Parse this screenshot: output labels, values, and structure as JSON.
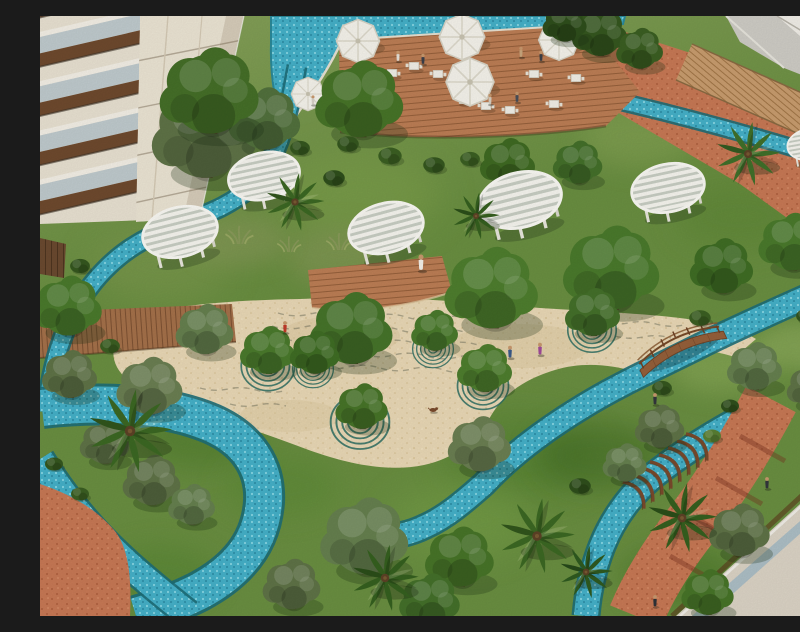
{
  "scene": {
    "description": "Aerial architectural rendering of a resort courtyard garden: winding turquoise mosaic streams, sandy plaza with concentric ring motifs around trees, white circular slatted pergolas, rooftop pool deck with white umbrellas, wooden arched bridge, palms and olive trees between residential buildings",
    "palette": {
      "grass": "#6a8f41",
      "grassDark": "#4c7229",
      "grassLight": "#85a855",
      "sand": "#ead9b6",
      "sandShadow": "#d8c193",
      "water": "#45b1c9",
      "waterDeep": "#1d6e78",
      "waterLight": "#8fdce8",
      "deckWood": "#bd7e55",
      "walkWood": "#c99d6f",
      "plankWood": "#a5714a",
      "terracotta": "#c87955",
      "terracottaDark": "#b0603e",
      "buildingCream": "#e9e2d2",
      "pergolaWhite": "#f7f6f0",
      "canopyGreen": "#4a7a2c",
      "canopyOlive": "#5f7347",
      "palmGreen": "#3c6823",
      "bridgeWood": "#8a5a33",
      "roofBeige": "#dcd4c6",
      "roofGlass": "#adbfc6",
      "ringTeal": "#2e6f63",
      "umbrellaWhite": "#f6f4ec"
    },
    "legend": "elements: t=symbol type, x/y=position px, s=scale, r=rotation deg, f=fill, layer=paint layer",
    "elements": [
      {
        "t": "patch",
        "n": "grass-patch",
        "layer": "ground",
        "x": 120,
        "y": 250,
        "s": 2.2,
        "f": "#7e9a4f"
      },
      {
        "t": "patch",
        "n": "grass-patch",
        "layer": "ground",
        "x": 320,
        "y": 180,
        "s": 2.5,
        "f": "#7fa14c"
      },
      {
        "t": "patch",
        "n": "grass-patch",
        "layer": "ground",
        "x": 600,
        "y": 120,
        "s": 1.8,
        "f": "#87a455"
      },
      {
        "t": "patch",
        "n": "grass-patch",
        "layer": "ground",
        "x": 700,
        "y": 200,
        "s": 2.0,
        "f": "#5d8636"
      },
      {
        "t": "patch",
        "n": "grass-patch",
        "layer": "ground",
        "x": 160,
        "y": 420,
        "s": 2.0,
        "f": "#4e7a2c"
      },
      {
        "t": "patch",
        "n": "grass-patch",
        "layer": "ground",
        "x": 480,
        "y": 440,
        "s": 2.4,
        "f": "#51802e"
      },
      {
        "t": "patch",
        "n": "grass-patch",
        "layer": "ground",
        "x": 680,
        "y": 350,
        "s": 1.6,
        "f": "#8fae5b"
      },
      {
        "t": "patch",
        "n": "grass-patch",
        "layer": "ground",
        "x": 240,
        "y": 470,
        "s": 1.8,
        "f": "#5c8a36"
      },
      {
        "t": "patch",
        "n": "grass-patch",
        "layer": "ground",
        "x": 420,
        "y": 505,
        "s": 2.2,
        "f": "#76a046"
      },
      {
        "t": "patch",
        "n": "grass-patch",
        "layer": "ground",
        "x": 120,
        "y": 560,
        "s": 1.8,
        "f": "#558532"
      },
      {
        "t": "patch",
        "n": "grass-patch",
        "layer": "ground",
        "x": 760,
        "y": 330,
        "s": 1.4,
        "f": "#97b363"
      },
      {
        "t": "patch",
        "n": "grass-patch",
        "layer": "ground",
        "x": 300,
        "y": 240,
        "s": 1.7,
        "f": "#8a9a5b"
      },
      {
        "t": "patch",
        "n": "grass-patch",
        "layer": "ground",
        "x": 200,
        "y": 225,
        "s": 1.5,
        "f": "#8a9a5b"
      },
      {
        "t": "patch",
        "n": "grass-patch",
        "layer": "ground",
        "x": 560,
        "y": 440,
        "s": 2.0,
        "f": "#3f6a22"
      },
      {
        "t": "patch",
        "n": "grass-patch",
        "layer": "ground",
        "x": 640,
        "y": 560,
        "s": 1.8,
        "f": "#477428"
      },
      {
        "t": "tuft",
        "n": "tall-grass",
        "x": 160,
        "y": 214,
        "s": 1.2
      },
      {
        "t": "tuft",
        "n": "tall-grass",
        "x": 198,
        "y": 228,
        "s": 1.4
      },
      {
        "t": "tuft",
        "n": "tall-grass",
        "x": 248,
        "y": 236,
        "s": 1.2
      },
      {
        "t": "tuft",
        "n": "tall-grass",
        "x": 298,
        "y": 234,
        "s": 1.3
      },
      {
        "t": "tuft",
        "n": "tall-grass",
        "x": 146,
        "y": 238,
        "s": 1.1
      },
      {
        "t": "tuft",
        "n": "tall-grass",
        "x": 338,
        "y": 226,
        "s": 1.2
      },
      {
        "t": "ring",
        "n": "ring-motif",
        "x": 228,
        "y": 350,
        "s": 1.05
      },
      {
        "t": "ring",
        "n": "ring-motif",
        "x": 320,
        "y": 406,
        "s": 1.15
      },
      {
        "t": "ring",
        "n": "ring-motif",
        "x": 443,
        "y": 370,
        "s": 1.0
      },
      {
        "t": "ring",
        "n": "ring-motif",
        "x": 552,
        "y": 314,
        "s": 0.95
      },
      {
        "t": "ring",
        "n": "ring-motif",
        "x": 393,
        "y": 333,
        "s": 0.8
      },
      {
        "t": "ring",
        "n": "ring-motif",
        "x": 273,
        "y": 353,
        "s": 0.8
      },
      {
        "t": "rib",
        "n": "stream-pergola-rib",
        "x": 658,
        "y": 430,
        "r": 52
      },
      {
        "t": "rib",
        "n": "stream-pergola-rib",
        "x": 649,
        "y": 437,
        "r": 52
      },
      {
        "t": "rib",
        "n": "stream-pergola-rib",
        "x": 640,
        "y": 444,
        "r": 52
      },
      {
        "t": "rib",
        "n": "stream-pergola-rib",
        "x": 631,
        "y": 451,
        "r": 52
      },
      {
        "t": "rib",
        "n": "stream-pergola-rib",
        "x": 622,
        "y": 458,
        "r": 52
      },
      {
        "t": "rib",
        "n": "stream-pergola-rib",
        "x": 613,
        "y": 464,
        "r": 52
      },
      {
        "t": "rib",
        "n": "stream-pergola-rib",
        "x": 604,
        "y": 471,
        "r": 52
      },
      {
        "t": "rib",
        "n": "stream-pergola-rib",
        "x": 595,
        "y": 478,
        "r": 52
      },
      {
        "t": "table",
        "n": "deck-table",
        "x": 352,
        "y": 57,
        "s": 1.2
      },
      {
        "t": "table",
        "n": "deck-table",
        "x": 374,
        "y": 50,
        "s": 1.2
      },
      {
        "t": "table",
        "n": "deck-table",
        "x": 398,
        "y": 58,
        "s": 1.2
      },
      {
        "t": "table",
        "n": "deck-table",
        "x": 424,
        "y": 84,
        "s": 1.2
      },
      {
        "t": "table",
        "n": "deck-table",
        "x": 446,
        "y": 90,
        "s": 1.2
      },
      {
        "t": "table",
        "n": "deck-table",
        "x": 470,
        "y": 94,
        "s": 1.2
      },
      {
        "t": "table",
        "n": "deck-table",
        "x": 494,
        "y": 58,
        "s": 1.2
      },
      {
        "t": "table",
        "n": "deck-table",
        "x": 514,
        "y": 88,
        "s": 1.2
      },
      {
        "t": "table",
        "n": "deck-table",
        "x": 536,
        "y": 62,
        "s": 1.2
      },
      {
        "t": "umbrella",
        "n": "pool-umbrella",
        "x": 318,
        "y": 25,
        "s": 1.8
      },
      {
        "t": "umbrella",
        "n": "pool-umbrella",
        "x": 422,
        "y": 21,
        "s": 1.9
      },
      {
        "t": "umbrella",
        "n": "pool-umbrella",
        "x": 430,
        "y": 66,
        "s": 2.0
      },
      {
        "t": "umbrella",
        "n": "pool-umbrella",
        "x": 519,
        "y": 24,
        "s": 1.7
      },
      {
        "t": "umbrella",
        "n": "pool-umbrella",
        "x": 268,
        "y": 78,
        "s": 1.4
      },
      {
        "t": "tree",
        "n": "tree",
        "x": 560,
        "y": 18,
        "s": 1.0,
        "f": "#35571f"
      },
      {
        "t": "tree",
        "n": "tree",
        "x": 600,
        "y": 34,
        "s": 0.85,
        "f": "#3b5f22"
      },
      {
        "t": "tree",
        "n": "tree",
        "x": 525,
        "y": 8,
        "s": 0.8,
        "f": "#2f4f1c"
      },
      {
        "t": "tree",
        "n": "olive-tree",
        "x": 165,
        "y": 120,
        "s": 1.9,
        "f": "#5f7347"
      },
      {
        "t": "tree",
        "n": "olive-tree",
        "x": 225,
        "y": 105,
        "s": 1.3,
        "f": "#52713d"
      },
      {
        "t": "tree",
        "n": "tree",
        "x": 170,
        "y": 78,
        "s": 1.8,
        "f": "#456f28"
      },
      {
        "t": "tree",
        "n": "tree",
        "x": 320,
        "y": 86,
        "s": 1.6,
        "f": "#477428"
      },
      {
        "t": "tree",
        "n": "tree",
        "x": 468,
        "y": 148,
        "s": 1.0,
        "f": "#3f6a22"
      },
      {
        "t": "tree",
        "n": "tree",
        "x": 538,
        "y": 148,
        "s": 0.9,
        "f": "#44702a"
      },
      {
        "t": "pergola",
        "n": "round-pergola",
        "x": 140,
        "y": 216,
        "s": 0.95,
        "r": -14
      },
      {
        "t": "pergola",
        "n": "round-pergola",
        "x": 224,
        "y": 160,
        "s": 0.9,
        "r": -12
      },
      {
        "t": "pergola",
        "n": "round-pergola",
        "x": 346,
        "y": 212,
        "s": 0.95,
        "r": -15
      },
      {
        "t": "pergola",
        "n": "round-pergola",
        "x": 480,
        "y": 184,
        "s": 1.05,
        "r": -14
      },
      {
        "t": "pergola",
        "n": "round-pergola",
        "x": 628,
        "y": 172,
        "s": 0.92,
        "r": -12
      },
      {
        "t": "pergola",
        "n": "round-pergola",
        "x": 772,
        "y": 128,
        "s": 0.62,
        "r": -10
      },
      {
        "t": "tree",
        "n": "tree",
        "x": 572,
        "y": 255,
        "s": 1.75,
        "f": "#4a7a2c"
      },
      {
        "t": "tree",
        "n": "tree",
        "x": 682,
        "y": 252,
        "s": 1.15,
        "f": "#3f6d24"
      },
      {
        "t": "tree",
        "n": "tree",
        "x": 752,
        "y": 228,
        "s": 1.2,
        "f": "#4a7a2c"
      },
      {
        "t": "tree",
        "n": "tree",
        "x": 452,
        "y": 275,
        "s": 1.7,
        "f": "#4e7e2e"
      },
      {
        "t": "tree",
        "n": "tree",
        "x": 312,
        "y": 315,
        "s": 1.5,
        "f": "#46742a"
      },
      {
        "t": "tree",
        "n": "tree",
        "x": 28,
        "y": 292,
        "s": 1.25,
        "f": "#4a7a2c"
      },
      {
        "t": "tree",
        "n": "olive-tree",
        "x": 110,
        "y": 372,
        "s": 1.2,
        "f": "#6b7f52"
      },
      {
        "t": "tree",
        "n": "olive-tree",
        "x": 30,
        "y": 360,
        "s": 1.0,
        "f": "#5f7347"
      },
      {
        "t": "tree",
        "n": "olive-tree",
        "x": 165,
        "y": 315,
        "s": 1.05,
        "f": "#66804f"
      },
      {
        "t": "tree",
        "n": "plaza-tree",
        "x": 228,
        "y": 336,
        "s": 1.0,
        "f": "#4a7a2c"
      },
      {
        "t": "tree",
        "n": "plaza-tree",
        "x": 322,
        "y": 392,
        "s": 0.95,
        "f": "#477428"
      },
      {
        "t": "tree",
        "n": "plaza-tree",
        "x": 445,
        "y": 354,
        "s": 1.0,
        "f": "#4e7e2e"
      },
      {
        "t": "tree",
        "n": "plaza-tree",
        "x": 553,
        "y": 298,
        "s": 1.0,
        "f": "#44702a"
      },
      {
        "t": "tree",
        "n": "plaza-tree",
        "x": 395,
        "y": 316,
        "s": 0.85,
        "f": "#4a7a2c"
      },
      {
        "t": "tree",
        "n": "plaza-tree",
        "x": 275,
        "y": 338,
        "s": 0.9,
        "f": "#3f6d24"
      },
      {
        "t": "tree",
        "n": "olive-tree",
        "x": 440,
        "y": 430,
        "s": 1.15,
        "f": "#6b7f52"
      },
      {
        "t": "tree",
        "n": "olive-tree",
        "x": 325,
        "y": 523,
        "s": 1.6,
        "f": "#66804f"
      },
      {
        "t": "tree",
        "n": "olive-tree",
        "x": 112,
        "y": 466,
        "s": 1.05,
        "f": "#5f7347"
      },
      {
        "t": "tree",
        "n": "olive-tree",
        "x": 152,
        "y": 490,
        "s": 0.85,
        "f": "#66804f"
      },
      {
        "t": "tree",
        "n": "olive-tree",
        "x": 65,
        "y": 428,
        "s": 0.9,
        "f": "#5f7347"
      },
      {
        "t": "tree",
        "n": "tree",
        "x": 420,
        "y": 543,
        "s": 1.25,
        "f": "#477428"
      },
      {
        "t": "tree",
        "n": "olive-tree",
        "x": 252,
        "y": 570,
        "s": 1.05,
        "f": "#5f7347"
      },
      {
        "t": "tree",
        "n": "tree",
        "x": 390,
        "y": 586,
        "s": 1.1,
        "f": "#44702a"
      },
      {
        "t": "tree",
        "n": "olive-tree",
        "x": 620,
        "y": 412,
        "s": 0.9,
        "f": "#5f7347"
      },
      {
        "t": "tree",
        "n": "olive-tree",
        "x": 585,
        "y": 448,
        "s": 0.8,
        "f": "#66804f"
      },
      {
        "t": "tree",
        "n": "olive-tree",
        "x": 715,
        "y": 352,
        "s": 1.0,
        "f": "#66804f"
      },
      {
        "t": "tree",
        "n": "olive-tree",
        "x": 772,
        "y": 372,
        "s": 0.9,
        "f": "#5f7347"
      },
      {
        "t": "tree",
        "n": "olive-tree",
        "x": 700,
        "y": 516,
        "s": 1.1,
        "f": "#5f7347"
      },
      {
        "t": "tree",
        "n": "tree",
        "x": 668,
        "y": 578,
        "s": 0.95,
        "f": "#477428"
      },
      {
        "t": "palm",
        "n": "palm-tree",
        "x": 90,
        "y": 415,
        "s": 1.5,
        "f": "#3c6823"
      },
      {
        "t": "palm",
        "n": "palm-tree",
        "x": 345,
        "y": 562,
        "s": 1.2,
        "f": "#35601f"
      },
      {
        "t": "palm",
        "n": "palm-tree",
        "x": 497,
        "y": 520,
        "s": 1.35,
        "f": "#3c6823"
      },
      {
        "t": "palm",
        "n": "palm-tree",
        "x": 642,
        "y": 502,
        "s": 1.25,
        "f": "#35601f"
      },
      {
        "t": "palm",
        "n": "palm-tree",
        "x": 255,
        "y": 186,
        "s": 1.05,
        "f": "#3c6823"
      },
      {
        "t": "palm",
        "n": "palm-tree",
        "x": 708,
        "y": 138,
        "s": 1.15,
        "f": "#40702a"
      },
      {
        "t": "palm",
        "n": "palm-tree",
        "x": 786,
        "y": 270,
        "s": 1.0,
        "f": "#3c6823"
      },
      {
        "t": "palm",
        "n": "palm-tree",
        "x": 436,
        "y": 200,
        "s": 0.85,
        "f": "#35601f"
      },
      {
        "t": "palm",
        "n": "palm-tree",
        "x": 546,
        "y": 556,
        "s": 0.95,
        "f": "#2f5a20"
      },
      {
        "t": "bush",
        "n": "bush",
        "x": 308,
        "y": 128,
        "s": 1.2,
        "f": "#35571f"
      },
      {
        "t": "bush",
        "n": "bush",
        "x": 350,
        "y": 140,
        "s": 1.3,
        "f": "#3b5f22"
      },
      {
        "t": "bush",
        "n": "bush",
        "x": 394,
        "y": 149,
        "s": 1.2,
        "f": "#35571f"
      },
      {
        "t": "bush",
        "n": "bush",
        "x": 430,
        "y": 143,
        "s": 1.1,
        "f": "#3b5f22"
      },
      {
        "t": "bush",
        "n": "bush",
        "x": 294,
        "y": 162,
        "s": 1.2,
        "f": "#2f4f1c"
      },
      {
        "t": "bush",
        "n": "bush",
        "x": 260,
        "y": 132,
        "s": 1.1,
        "f": "#35571f"
      },
      {
        "t": "bush",
        "n": "bush",
        "x": 660,
        "y": 302,
        "s": 1.2,
        "f": "#3b5f22"
      },
      {
        "t": "bush",
        "n": "bush",
        "x": 622,
        "y": 372,
        "s": 1.1,
        "f": "#35571f"
      },
      {
        "t": "bush",
        "n": "bush",
        "x": 540,
        "y": 470,
        "s": 1.2,
        "f": "#2f4f1c"
      },
      {
        "t": "bush",
        "n": "bush",
        "x": 766,
        "y": 300,
        "s": 1.1,
        "f": "#35571f"
      },
      {
        "t": "bush",
        "n": "bush",
        "x": 70,
        "y": 330,
        "s": 1.1,
        "f": "#3b5f22"
      },
      {
        "t": "bush",
        "n": "bush",
        "x": 40,
        "y": 250,
        "s": 1.1,
        "f": "#35571f"
      },
      {
        "t": "bush",
        "n": "bush",
        "x": 690,
        "y": 390,
        "s": 1.0,
        "f": "#2f4f1c"
      },
      {
        "t": "bush",
        "n": "bush",
        "x": 770,
        "y": 252,
        "s": 1.0,
        "f": "#35571f"
      },
      {
        "t": "bush",
        "n": "bush",
        "x": 14,
        "y": 448,
        "s": 1.0,
        "f": "#35571f"
      },
      {
        "t": "bush",
        "n": "bush",
        "x": 40,
        "y": 478,
        "s": 1.0,
        "f": "#3b5f22"
      },
      {
        "t": "bush",
        "n": "bush",
        "x": 672,
        "y": 420,
        "s": 1.0,
        "f": "#597f33"
      },
      {
        "t": "person",
        "n": "deck-person",
        "x": 358,
        "y": 41,
        "s": 1.0,
        "f": "#e8e3da"
      },
      {
        "t": "person",
        "n": "deck-person",
        "x": 383,
        "y": 44,
        "s": 1.0,
        "f": "#3a3f4a"
      },
      {
        "t": "person",
        "n": "deck-person",
        "x": 450,
        "y": 84,
        "s": 1.0,
        "f": "#d8cfc0"
      },
      {
        "t": "person",
        "n": "deck-person",
        "x": 477,
        "y": 82,
        "s": 1.0,
        "f": "#4a4f58"
      },
      {
        "t": "person",
        "n": "deck-person",
        "x": 481,
        "y": 37,
        "s": 1.0,
        "f": "#caa87e"
      },
      {
        "t": "person",
        "n": "deck-person",
        "x": 501,
        "y": 41,
        "s": 1.0,
        "f": "#3c4048"
      },
      {
        "t": "person",
        "n": "pool-person",
        "x": 273,
        "y": 85,
        "s": 0.9,
        "f": "#d9d2c8"
      },
      {
        "t": "person",
        "n": "robed-man",
        "x": 381,
        "y": 248,
        "s": 1.5,
        "f": "#f5f2ea"
      },
      {
        "t": "person",
        "n": "plaza-person",
        "x": 470,
        "y": 337,
        "s": 1.15,
        "f": "#3a5a8a"
      },
      {
        "t": "person",
        "n": "plaza-person",
        "x": 500,
        "y": 334,
        "s": 1.15,
        "f": "#a04a9a"
      },
      {
        "t": "person",
        "n": "plaza-person",
        "x": 245,
        "y": 312,
        "s": 1.1,
        "f": "#c23a2a"
      },
      {
        "t": "person",
        "n": "garden-person",
        "x": 615,
        "y": 384,
        "s": 1.1,
        "f": "#33363c"
      },
      {
        "t": "person",
        "n": "path-person",
        "x": 727,
        "y": 468,
        "s": 1.1,
        "f": "#33363c"
      },
      {
        "t": "person",
        "n": "path-person",
        "x": 615,
        "y": 586,
        "s": 1.1,
        "f": "#2f3238"
      },
      {
        "t": "dog",
        "n": "dog",
        "x": 393,
        "y": 394,
        "s": 1.1,
        "f": "#7a4a2c"
      }
    ]
  }
}
